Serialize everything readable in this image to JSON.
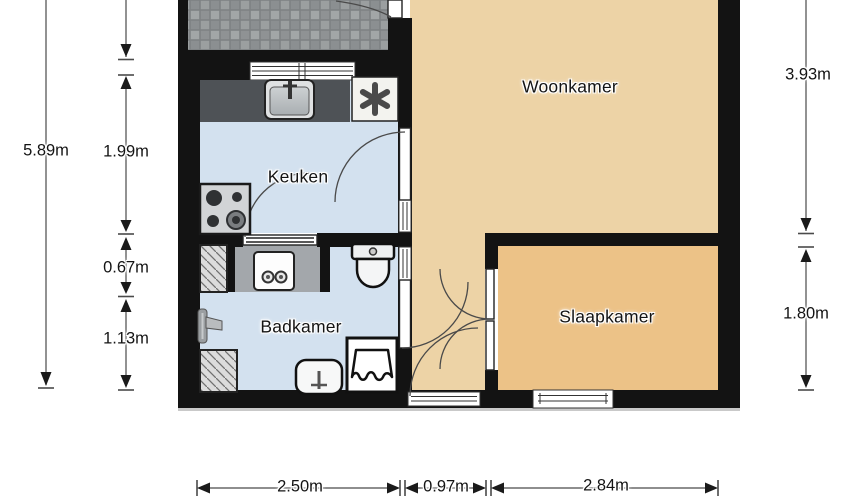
{
  "floorplan": {
    "rooms": {
      "woonkamer": {
        "label": "Woonkamer"
      },
      "keuken": {
        "label": "Keuken"
      },
      "badkamer": {
        "label": "Badkamer"
      },
      "slaapkamer": {
        "label": "Slaapkamer"
      }
    },
    "dimensions": {
      "left_total": "5.89m",
      "kitchen_depth": "1.99m",
      "utility_depth": "0.67m",
      "bathroom_depth": "1.13m",
      "living_depth": "3.93m",
      "bedroom_depth": "1.80m",
      "bottom_kitchen_width": "2.50m",
      "bottom_hall_width": "0.97m",
      "bottom_bedroom_width": "2.84m"
    },
    "icons": {
      "boiler": "asterisk"
    },
    "colors": {
      "wall": "#131313",
      "living_floor": "#edd3a6",
      "bedroom_floor": "#ecc287",
      "wet_room_floor": "#d3e1ef",
      "counter": "#4e5256",
      "balcony_tile": "#8f9294",
      "background": "#ffffff"
    }
  }
}
